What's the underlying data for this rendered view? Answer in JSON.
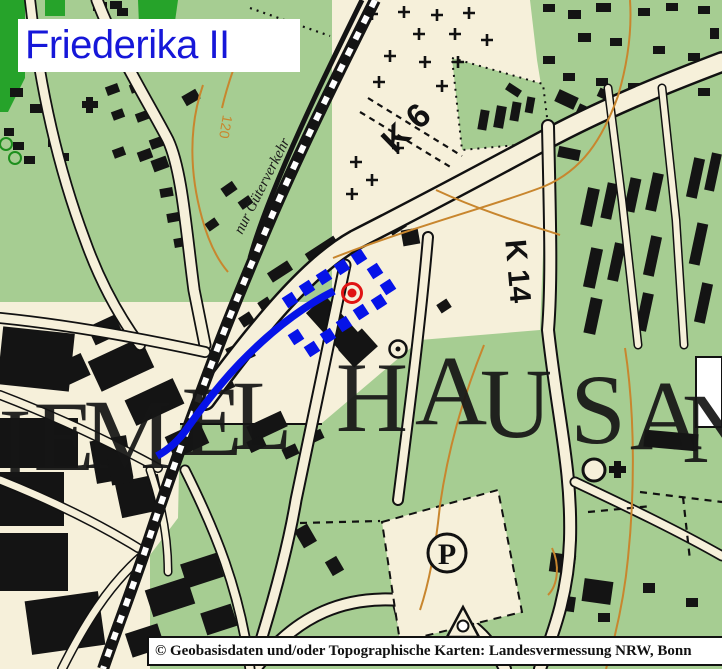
{
  "title": {
    "text": "Friederika II"
  },
  "attribution": {
    "text": "© Geobasisdaten und/oder Topographische Karten: Landesvermessung NRW, Bonn"
  },
  "labels": {
    "road_k6": "K 6",
    "road_k14": "K 14",
    "railway_note": "nur Güterverkehr",
    "contour_120": "120",
    "parking": "P"
  },
  "colors": {
    "overlay_blue": "#0613e8",
    "marker_red": "#e01414",
    "green": "#a6cd92",
    "dark_green": "#26a32a",
    "cream": "#f6f0da",
    "contour_orange": "#c8862e",
    "title_blue": "#1617d9"
  },
  "place_name_letters": [
    {
      "ch": "I",
      "x": 15,
      "y": 477
    },
    {
      "ch": "E",
      "x": 64,
      "y": 470
    },
    {
      "ch": "M",
      "x": 128,
      "y": 468
    },
    {
      "ch": "E",
      "x": 212,
      "y": 455
    },
    {
      "ch": "L",
      "x": 262,
      "y": 449
    },
    {
      "ch": "H",
      "x": 372,
      "y": 431
    },
    {
      "ch": "A",
      "x": 451,
      "y": 424
    },
    {
      "ch": "U",
      "x": 516,
      "y": 437
    },
    {
      "ch": "S",
      "x": 598,
      "y": 443
    },
    {
      "ch": "A",
      "x": 666,
      "y": 449
    },
    {
      "ch": "N",
      "x": 718,
      "y": 462
    }
  ],
  "overlay": {
    "gallery_path": "M334,291 C300,308 268,334 240,363 C218,386 200,410 186,430 C176,444 166,451 157,456",
    "dots": [
      [
        290,
        300
      ],
      [
        307,
        288
      ],
      [
        324,
        277
      ],
      [
        342,
        267
      ],
      [
        359,
        257
      ],
      [
        375,
        271
      ],
      [
        388,
        287
      ],
      [
        379,
        302
      ],
      [
        361,
        312
      ],
      [
        344,
        324
      ],
      [
        328,
        336
      ],
      [
        312,
        349
      ],
      [
        296,
        337
      ]
    ],
    "marker": {
      "x": 352,
      "y": 293
    }
  },
  "map_features": {
    "crosses": [
      [
        372,
        14
      ],
      [
        404,
        12
      ],
      [
        437,
        15
      ],
      [
        469,
        13
      ],
      [
        419,
        34
      ],
      [
        455,
        34
      ],
      [
        487,
        40
      ],
      [
        390,
        56
      ],
      [
        425,
        62
      ],
      [
        458,
        62
      ],
      [
        379,
        82
      ],
      [
        442,
        86
      ],
      [
        398,
        148
      ],
      [
        356,
        162
      ],
      [
        372,
        180
      ],
      [
        352,
        194
      ]
    ],
    "buildings": [
      [
        10,
        88,
        13,
        9,
        0
      ],
      [
        30,
        104,
        12,
        9,
        0
      ],
      [
        4,
        128,
        10,
        8,
        0
      ],
      [
        13,
        142,
        11,
        8,
        0
      ],
      [
        24,
        156,
        11,
        8,
        0
      ],
      [
        48,
        138,
        12,
        9,
        0
      ],
      [
        58,
        153,
        11,
        8,
        0
      ],
      [
        93,
        2,
        14,
        9,
        0
      ],
      [
        110,
        1,
        12,
        8,
        0
      ],
      [
        117,
        8,
        11,
        8,
        0
      ],
      [
        82,
        101,
        16,
        7,
        0
      ],
      [
        86,
        97,
        7,
        16,
        0
      ],
      [
        106,
        85,
        13,
        9,
        -20
      ],
      [
        130,
        83,
        12,
        9,
        -20
      ],
      [
        112,
        110,
        12,
        9,
        -20
      ],
      [
        136,
        112,
        12,
        9,
        -20
      ],
      [
        150,
        138,
        13,
        10,
        -20
      ],
      [
        113,
        148,
        12,
        9,
        -20
      ],
      [
        138,
        150,
        14,
        10,
        -20
      ],
      [
        152,
        158,
        16,
        12,
        -20
      ],
      [
        160,
        188,
        13,
        9,
        -10
      ],
      [
        167,
        213,
        12,
        9,
        -10
      ],
      [
        174,
        238,
        12,
        9,
        -10
      ],
      [
        222,
        184,
        14,
        10,
        -35
      ],
      [
        239,
        198,
        13,
        9,
        -35
      ],
      [
        206,
        220,
        12,
        9,
        -35
      ],
      [
        183,
        92,
        16,
        11,
        -30
      ],
      [
        305,
        244,
        34,
        11,
        -33
      ],
      [
        268,
        266,
        24,
        11,
        -33
      ],
      [
        388,
        220,
        17,
        12,
        -33
      ],
      [
        240,
        314,
        13,
        11,
        -33
      ],
      [
        259,
        299,
        12,
        10,
        -33
      ],
      [
        402,
        229,
        17,
        16,
        -10
      ],
      [
        438,
        301,
        12,
        10,
        -33
      ],
      [
        322,
        297,
        26,
        58,
        -42
      ],
      [
        342,
        336,
        32,
        24,
        -42
      ],
      [
        479,
        110,
        9,
        20,
        10
      ],
      [
        495,
        106,
        10,
        22,
        10
      ],
      [
        511,
        102,
        9,
        19,
        10
      ],
      [
        526,
        97,
        8,
        16,
        10
      ],
      [
        506,
        86,
        15,
        8,
        33
      ],
      [
        556,
        93,
        21,
        13,
        25
      ],
      [
        577,
        106,
        15,
        11,
        25
      ],
      [
        598,
        90,
        13,
        9,
        25
      ],
      [
        543,
        4,
        12,
        8,
        0
      ],
      [
        568,
        10,
        13,
        9,
        0
      ],
      [
        596,
        3,
        15,
        9,
        0
      ],
      [
        638,
        8,
        12,
        8,
        0
      ],
      [
        666,
        3,
        12,
        8,
        0
      ],
      [
        698,
        6,
        12,
        8,
        0
      ],
      [
        710,
        28,
        9,
        11,
        0
      ],
      [
        578,
        33,
        13,
        9,
        0
      ],
      [
        610,
        38,
        12,
        8,
        0
      ],
      [
        653,
        46,
        12,
        8,
        0
      ],
      [
        688,
        53,
        12,
        8,
        0
      ],
      [
        543,
        56,
        12,
        8,
        0
      ],
      [
        563,
        73,
        12,
        8,
        0
      ],
      [
        596,
        78,
        12,
        8,
        0
      ],
      [
        628,
        83,
        12,
        8,
        0
      ],
      [
        698,
        88,
        12,
        8,
        0
      ],
      [
        584,
        188,
        12,
        38,
        12
      ],
      [
        604,
        183,
        11,
        36,
        12
      ],
      [
        627,
        178,
        11,
        34,
        12
      ],
      [
        649,
        173,
        11,
        38,
        12
      ],
      [
        690,
        158,
        11,
        40,
        12
      ],
      [
        708,
        153,
        10,
        38,
        12
      ],
      [
        587,
        248,
        12,
        40,
        12
      ],
      [
        611,
        243,
        11,
        38,
        12
      ],
      [
        647,
        236,
        11,
        40,
        12
      ],
      [
        693,
        223,
        11,
        42,
        12
      ],
      [
        587,
        298,
        12,
        36,
        12
      ],
      [
        639,
        293,
        11,
        38,
        12
      ],
      [
        698,
        283,
        11,
        40,
        12
      ],
      [
        558,
        148,
        22,
        11,
        12
      ],
      [
        92,
        348,
        58,
        33,
        -25
      ],
      [
        128,
        388,
        53,
        28,
        -25
      ],
      [
        58,
        358,
        29,
        24,
        -25
      ],
      [
        168,
        428,
        38,
        24,
        -25
      ],
      [
        203,
        373,
        29,
        21,
        -25
      ],
      [
        228,
        343,
        25,
        19,
        -25
      ],
      [
        248,
        418,
        38,
        17,
        -25
      ],
      [
        90,
        320,
        30,
        20,
        -25
      ],
      [
        0,
        330,
        72,
        58,
        6
      ],
      [
        0,
        418,
        78,
        50,
        0
      ],
      [
        0,
        472,
        64,
        54,
        0
      ],
      [
        0,
        533,
        68,
        58,
        0
      ],
      [
        28,
        596,
        74,
        54,
        -8
      ],
      [
        93,
        438,
        37,
        43,
        -10
      ],
      [
        118,
        478,
        44,
        36,
        -12
      ],
      [
        108,
        438,
        22,
        46,
        -10
      ],
      [
        148,
        583,
        44,
        28,
        -18
      ],
      [
        183,
        558,
        38,
        25,
        -18
      ],
      [
        203,
        608,
        32,
        23,
        -18
      ],
      [
        128,
        628,
        34,
        25,
        -18
      ],
      [
        298,
        526,
        15,
        20,
        -30
      ],
      [
        328,
        558,
        13,
        16,
        -30
      ],
      [
        396,
        598,
        33,
        38,
        -15
      ],
      [
        248,
        438,
        17,
        12,
        -25
      ],
      [
        283,
        446,
        15,
        11,
        -25
      ],
      [
        310,
        431,
        13,
        10,
        -25
      ],
      [
        550,
        554,
        25,
        19,
        8
      ],
      [
        583,
        580,
        29,
        23,
        8
      ],
      [
        556,
        596,
        19,
        15,
        8
      ],
      [
        598,
        613,
        12,
        9,
        0
      ],
      [
        643,
        583,
        12,
        10,
        0
      ],
      [
        686,
        598,
        12,
        9,
        0
      ],
      [
        658,
        638,
        11,
        9,
        0
      ],
      [
        618,
        646,
        11,
        9,
        0
      ],
      [
        702,
        363,
        18,
        21,
        0
      ],
      [
        702,
        393,
        18,
        27,
        0
      ],
      [
        644,
        432,
        54,
        17,
        5
      ]
    ]
  }
}
